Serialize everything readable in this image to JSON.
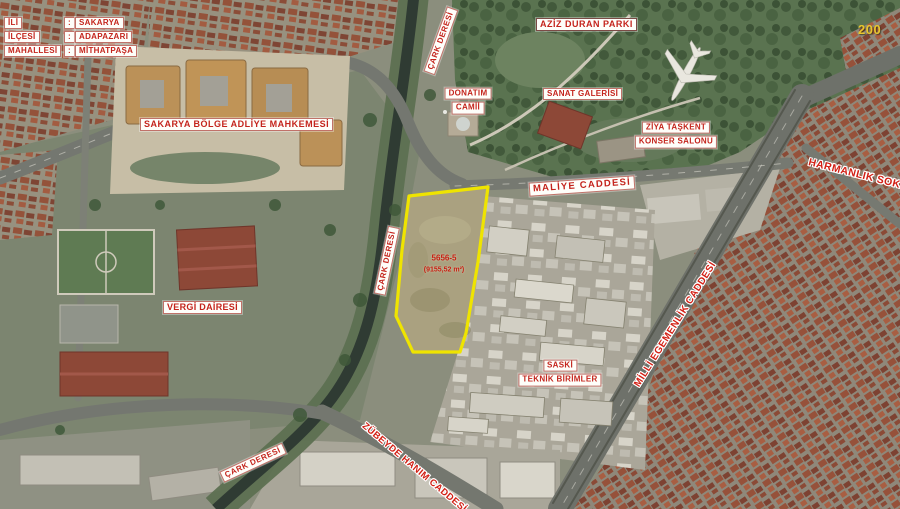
{
  "map": {
    "watermark": "200",
    "info_panel": {
      "rows": [
        {
          "label": "İLİ",
          "sep": ":",
          "value": "SAKARYA"
        },
        {
          "label": "İLÇESİ",
          "sep": ":",
          "value": "ADAPAZARI"
        },
        {
          "label": "MAHALLESİ",
          "sep": ":",
          "value": "MİTHATPAŞA"
        }
      ]
    },
    "places": {
      "courthouse": "SAKARYA BÖLGE ADLİYE MAHKEMESİ",
      "park": "AZİZ DURAN PARKI",
      "mosque_line1": "DONATIM",
      "mosque_line2": "CAMİİ",
      "art_gallery": "SANAT GALERİSİ",
      "concert_line1": "ZİYA TAŞKENT",
      "concert_line2": "KONSER SALONU",
      "tax_office": "VERGİ DAİRESİ",
      "saski_line1": "SASKİ",
      "saski_line2": "TEKNİK BİRİMLER"
    },
    "streets": {
      "maliye": "MALİYE CADDESİ",
      "harmanlik": "HARMANLIK SOKAK",
      "milli_egemenlik": "MİLLİ EGEMENLİK CADDESİ",
      "zubeyde": "ZÜBEYDE HANIM CADDESİ",
      "stream_top": "ÇARK DERESİ",
      "stream_mid": "ÇARK DERESİ",
      "stream_bottom": "ÇARK DERESİ"
    },
    "parcel": {
      "number": "5656-5",
      "area": "(9155,52 m²)",
      "outline_color": "#efe400"
    },
    "colors": {
      "label_text": "#c4241c",
      "label_bg": "#ffffff",
      "watermark_text": "#e9c52d"
    }
  }
}
